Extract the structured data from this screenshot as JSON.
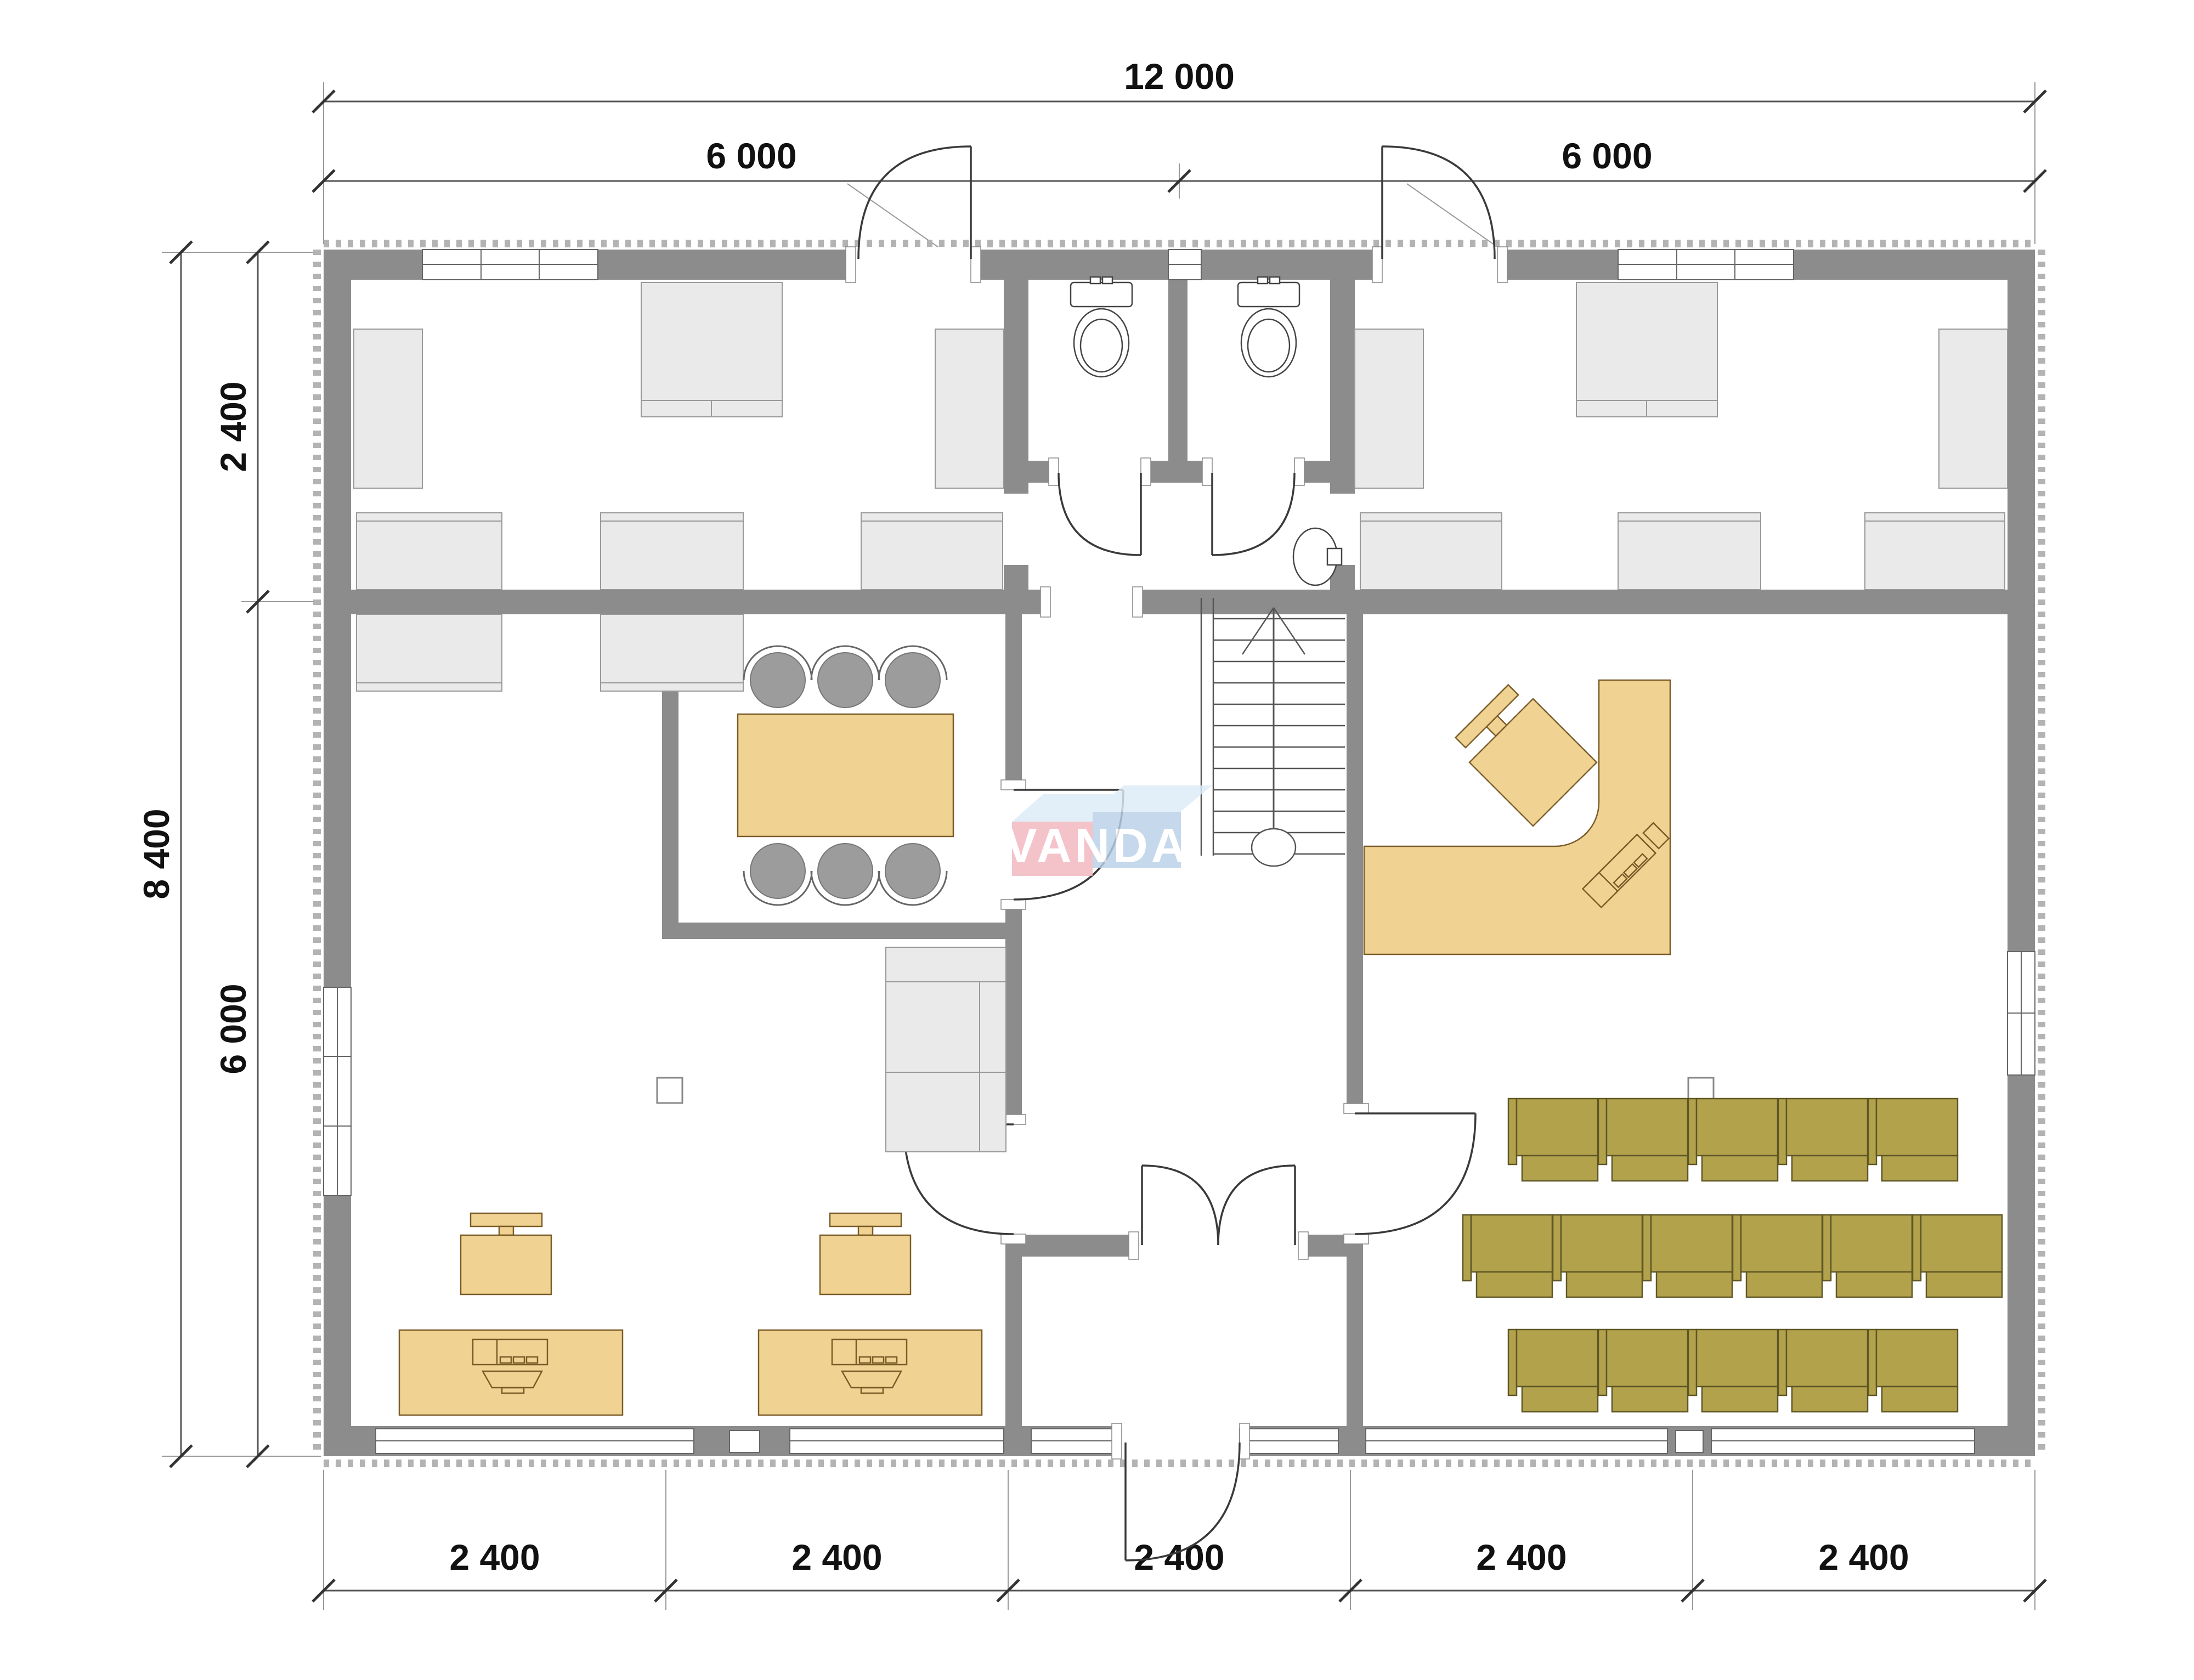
{
  "drawing": {
    "type": "architectural floor plan",
    "watermark": "VANDA"
  },
  "dimensions": {
    "top_total": "12 000",
    "top_left": "6 000",
    "top_right": "6 000",
    "left_total": "8 400",
    "left_upper": "2 400",
    "left_lower": "6 000",
    "bottom_segments": [
      "2 400",
      "2 400",
      "2 400",
      "2 400",
      "2 400"
    ]
  },
  "colors": {
    "wall": "#8c8c8c",
    "furniture_gray": "#eaeaea",
    "furniture_tan": "#f0d292",
    "tan_outline": "#7a5c28",
    "chair_olive": "#b2a24c",
    "olive_outline": "#5f5626",
    "meeting_chair_gray": "#9c9c9c",
    "logo_pink": "#f2b6bf",
    "logo_blue": "#b9d0e8",
    "logo_top_face": "#dcebf7",
    "dimension_text": "#111111"
  }
}
